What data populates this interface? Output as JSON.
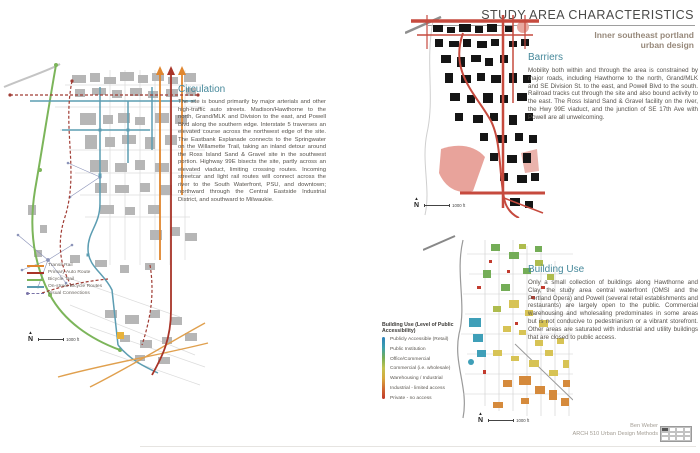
{
  "header": {
    "title": "STUDY AREA CHARACTERISTICS",
    "subtitle_line1": "Inner southeast portland",
    "subtitle_line2": "urban design"
  },
  "sections": {
    "circulation": {
      "heading": "Circulation",
      "body": "The site is bound primarily by major arterials and other high-traffic auto streets. Madison/Hawthorne to the north, Grand/MLK and Division to the east, and Powell Blvd along the southern edge. Interstate 5 traverses an elevated course across the northwest edge of the site. The Eastbank Esplanade connects to the Springwater on the Willamette Trail, taking an inland detour around the Ross Island Sand & Gravel site in the southwest portion. Highway 99E bisects the site, partly across an elevated viaduct, limiting crossing routes. Incoming streetcar and light rail routes will connect across the river to the South Waterfront, PSU, and downtown; northward through the Central Eastside Industrial District, and southward to Milwaukie."
    },
    "barriers": {
      "heading": "Barriers",
      "body": "Mobility both within and through the area is constrained by major roads, including Hawthorne to the north, Grand/MLK and SE Division St. to the east, and Powell Blvd to the south. Railroad tracks cut through the site and also bound activity to the east. The Ross Island Sand & Gravel facility on the river, the Hwy 99E viaduct, and the junction of SE 17th Ave with Powell are all unwelcoming."
    },
    "building_use": {
      "heading": "Building Use",
      "body": "Only a small collection of buildings along Hawthorne and Clay, the study area central waterfront (OMSI and the Portland Opera) and Powell (several retail establishments and restaurants) are largely open to the public. Commercial warehousing and wholesaling predominates in some areas but is not conducive to pedestrianism or a vibrant storefront. Other areas are saturated with industrial and utility buildings that are closed to public access."
    }
  },
  "circulation_legend": {
    "items": [
      {
        "label": "Transit Rail",
        "color": "#e0862e",
        "style": "solid"
      },
      {
        "label": "Primary Auto Route",
        "color": "#a83428",
        "style": "solid"
      },
      {
        "label": "Bicycle Trail",
        "color": "#7cb55a",
        "style": "solid"
      },
      {
        "label": "On-street Bicycle Routes",
        "color": "#5b9bb0",
        "style": "solid"
      },
      {
        "label": "Visual Connections",
        "color": "#7a74a8",
        "style": "dashed-dot"
      }
    ]
  },
  "building_legend": {
    "title": "Building Use (Level of Public Accessibility)",
    "items": [
      {
        "label": "Publicly Accessible (Retail)",
        "color": "#2d7fb8"
      },
      {
        "label": "Public Institution",
        "color": "#3aa0b0"
      },
      {
        "label": "Office/Commercial",
        "color": "#74ad57"
      },
      {
        "label": "Commercial (i.e. wholesale)",
        "color": "#c2c24e"
      },
      {
        "label": "Warehousing / Industrial",
        "color": "#d7a83c"
      },
      {
        "label": "Industrial - limited access",
        "color": "#d06a32"
      },
      {
        "label": "Private - no access",
        "color": "#c0392b"
      }
    ]
  },
  "map_annotations": {
    "north_label": "N",
    "north_arrow": "▲",
    "scale_label": "1000 ft"
  },
  "credits": {
    "name": "Ben Weber",
    "course": "ARCH 510 Urban Design Methods"
  },
  "colors": {
    "heading_teal": "#47899b",
    "title_charcoal": "#4a4a48",
    "subtitle_brown": "#97897b",
    "barrier_red": "#c0392b",
    "building_gray": "#b6b6b6",
    "black_building": "#151515"
  }
}
